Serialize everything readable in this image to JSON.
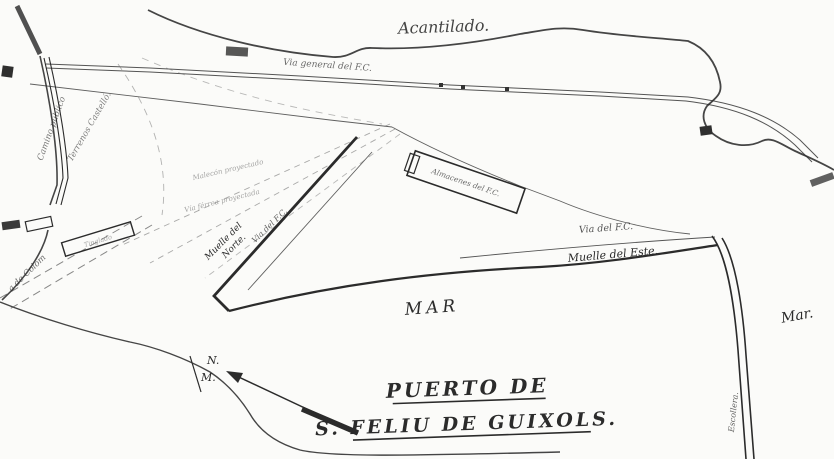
{
  "map": {
    "type": "scanned hand-drawn harbor plan",
    "title": {
      "line1": "PUERTO DE",
      "line2": "S. FELIU DE GUIXOLS."
    },
    "labels": {
      "acantilado": "Acantilado.",
      "via_general": "Via general del F.C.",
      "camino_publico": "Camino público",
      "terrenos_castello": "Terrenos Castelló.",
      "proyectado1": "Malecón proyectado",
      "proyectado2": "Vía férrea proyectada",
      "muelle_norte_l1": "Muelle del",
      "muelle_norte_l2": "Norte.",
      "via_fc_norte": "Via del F.C.",
      "almacenes": "Almacenes del F.C.",
      "via_fc_este": "Via del F.C.",
      "muelle_este": "Muelle del Este.",
      "mar_center": "MAR",
      "mar_right": "Mar.",
      "colom": "a de Colom",
      "tinglado": "Tinglado",
      "escollera": "Escollera.",
      "compass_n": "N.",
      "compass_m": "M."
    },
    "features": [
      "cliff coastline (Acantilado) along top",
      "main railway line (Via general del F.C.) with small buildings",
      "public road (Camino público) on the left",
      "dashed boundary of Terrenos Castelló",
      "dashed projected works radiating from rail junction",
      "North quay (Muelle del Norte) with railway branch",
      "F.C. warehouse block (Almacenes del F.C.) on the quay",
      "East quay (Muelle del Este) with railway",
      "east breakwater (Escollera) running to bottom edge",
      "magnetic north compass arrow (N.M.)",
      "sea areas marked MAR and Mar."
    ]
  },
  "colors": {
    "paper": "#fbfbf9",
    "ink": "#2b2b2b",
    "faint": "#8a8a8a"
  }
}
